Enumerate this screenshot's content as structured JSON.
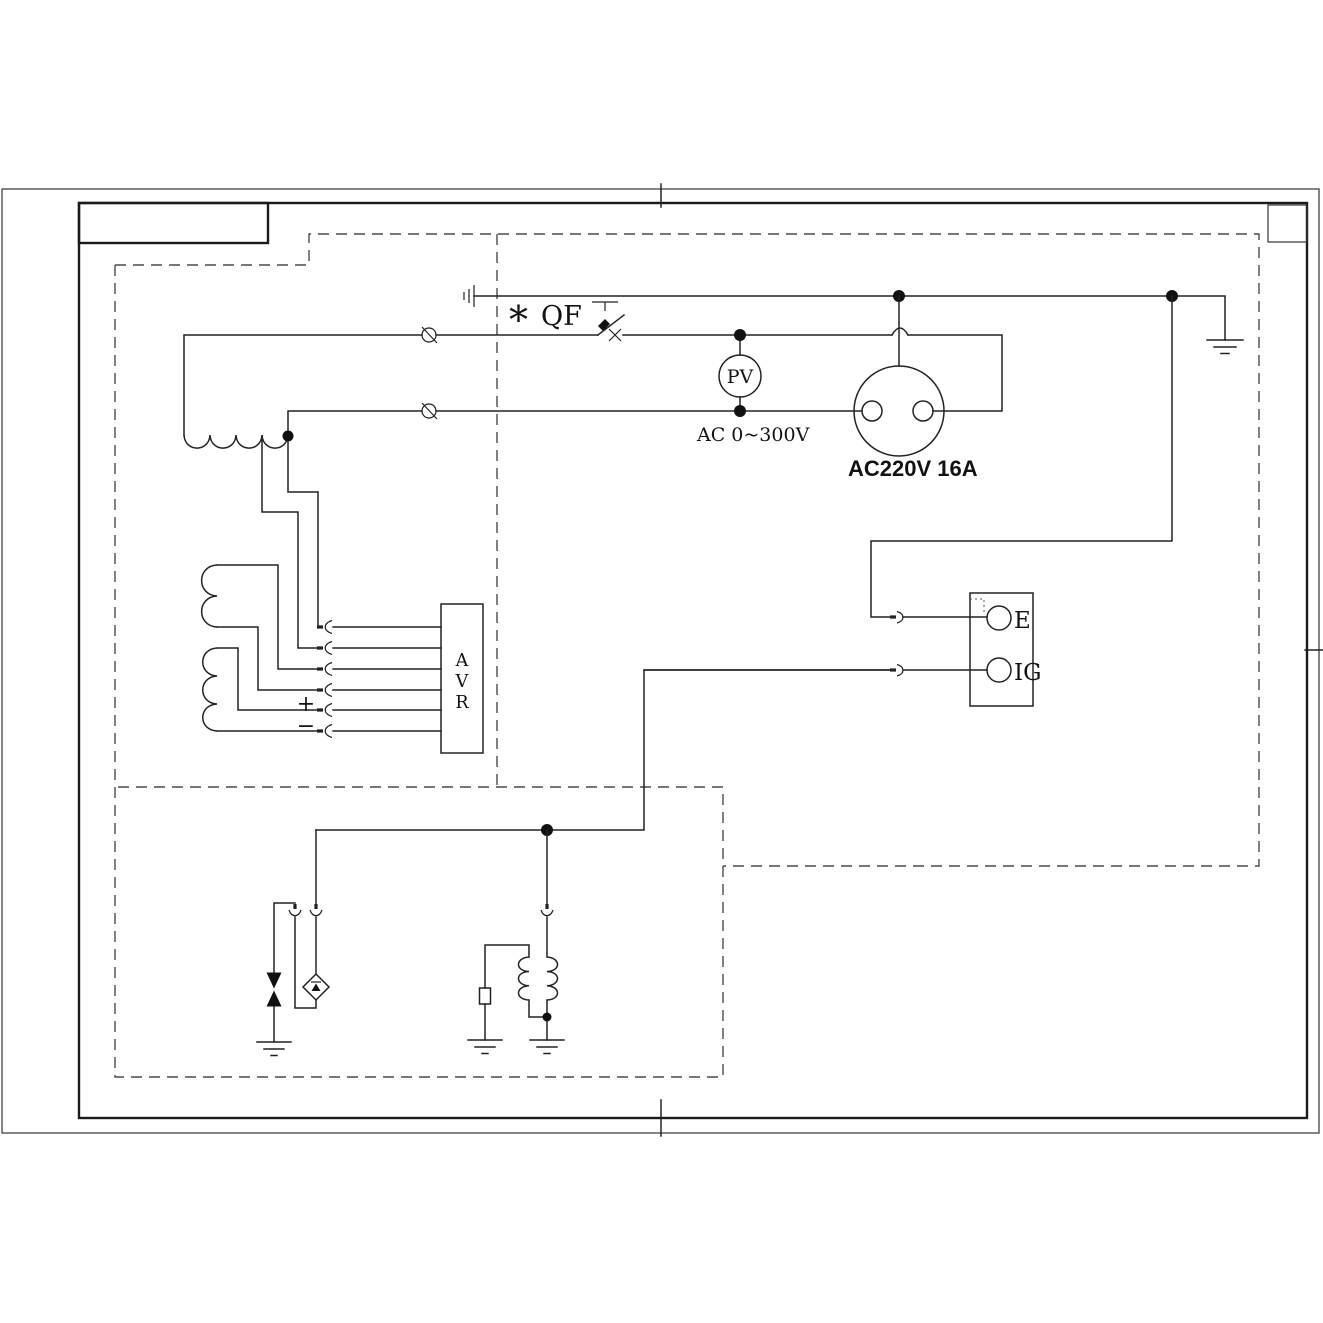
{
  "labels": {
    "breaker_star": "*",
    "breaker": "QF",
    "voltmeter": "PV",
    "voltmeter_range": "AC 0~300V",
    "socket_rating": "AC220V 16A",
    "avr_letters": [
      "A",
      "V",
      "R"
    ],
    "plus": "+",
    "minus": "−",
    "terminal_e": "E",
    "terminal_ig": "IG"
  },
  "colors": {
    "line": "#222222",
    "dashed_boundary": "#4a4a4a",
    "background": "#ffffff"
  }
}
